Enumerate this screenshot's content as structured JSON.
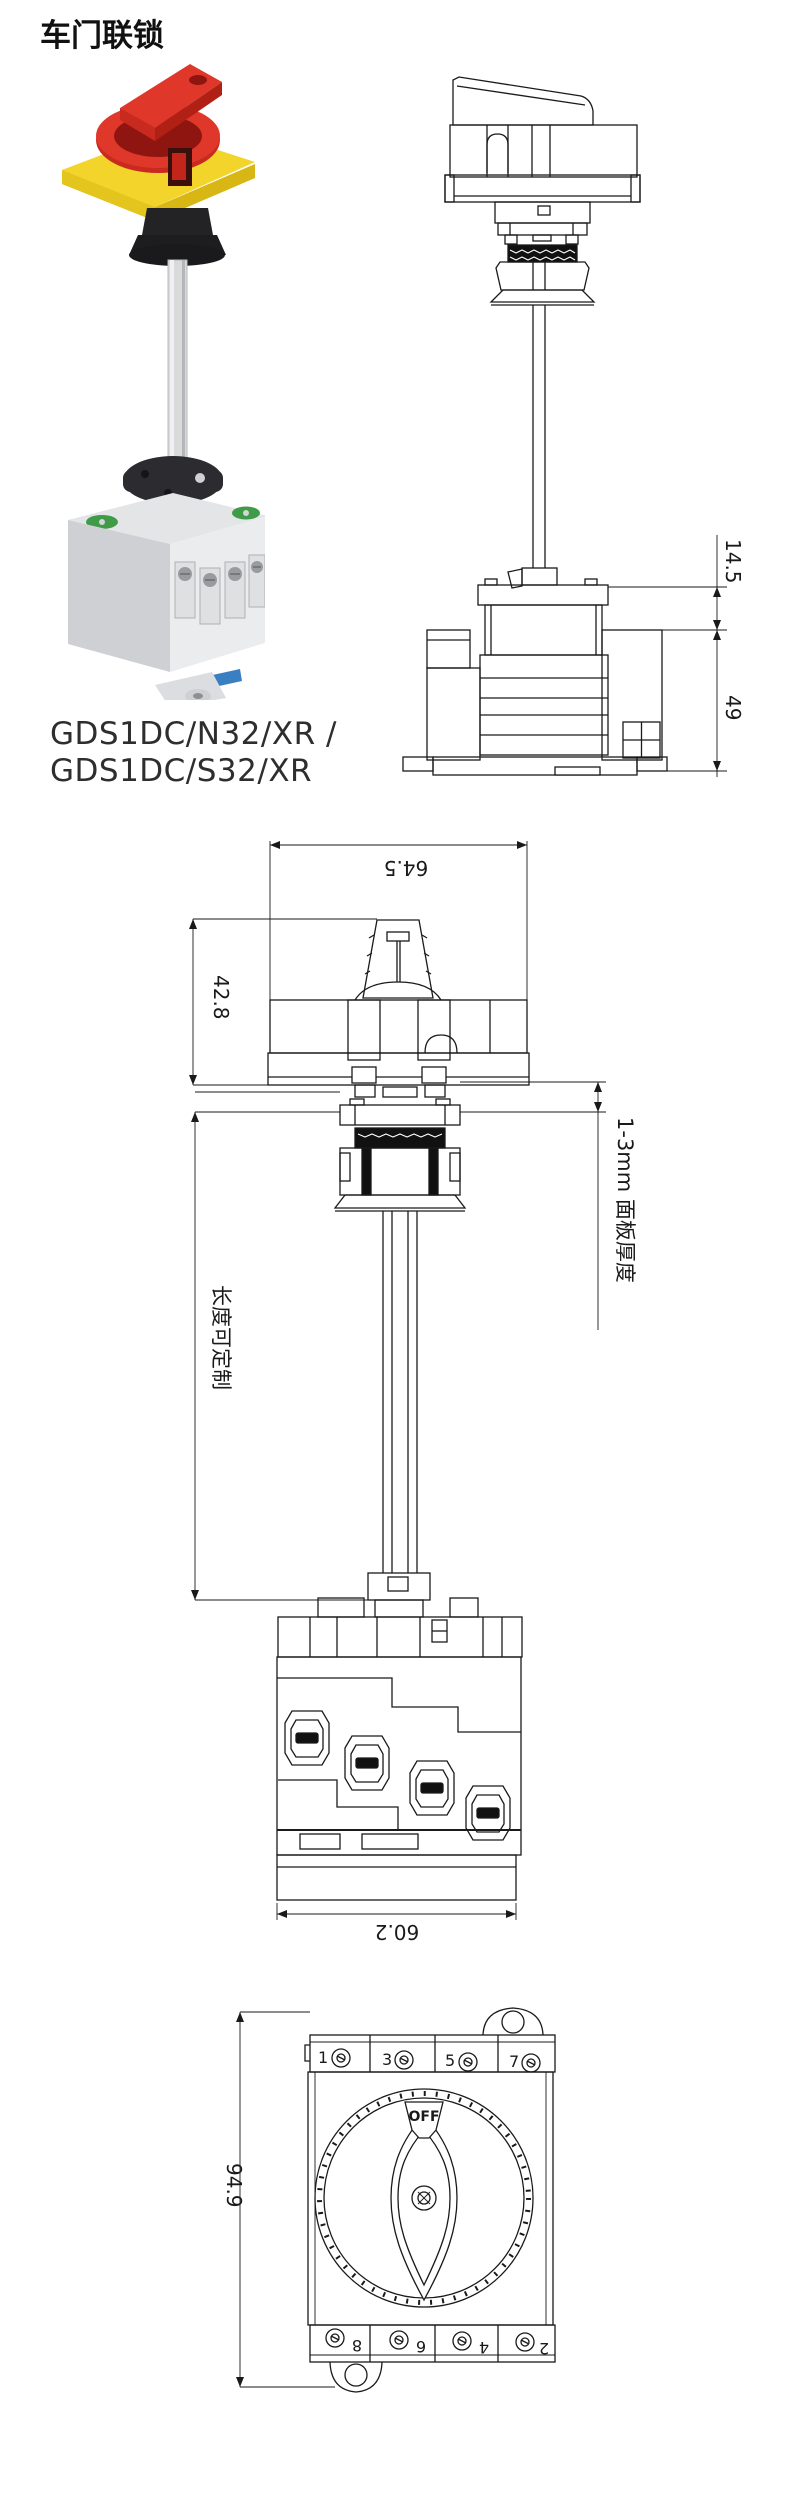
{
  "page": {
    "title": "车门联锁"
  },
  "product": {
    "model_line1": "GDS1DC/N32/XR /",
    "model_line2": "GDS1DC/S32/XR",
    "photo_colors": {
      "handle_red": "#e0372b",
      "handle_red_dark": "#b02015",
      "plate_yellow": "#f2d42a",
      "plate_yellow_dark": "#d8b714",
      "coupling_black": "#232326",
      "shaft_gray": "#d9dadc",
      "body_gray": "#e4e5e7",
      "body_gray_dark": "#cfd0d3",
      "disc_dark": "#2c2b2f",
      "pad_green": "#3f9b48",
      "clip_blue": "#3a7fc1"
    }
  },
  "drawings": {
    "side_view": {
      "dim_top": "14.5",
      "dim_body_height": "49"
    },
    "handle_view": {
      "dim_width": "64.5",
      "dim_height": "42.8",
      "length_note": "长度可定制",
      "panel_note": "1-3mm 面板厚度",
      "dim_body_width": "60.2"
    },
    "front_view": {
      "dim_height": "94.9",
      "off_label": "OFF",
      "terminals_top": [
        "1",
        "3",
        "5",
        "7"
      ],
      "terminals_bottom": [
        "8",
        "6",
        "4",
        "2"
      ]
    }
  }
}
